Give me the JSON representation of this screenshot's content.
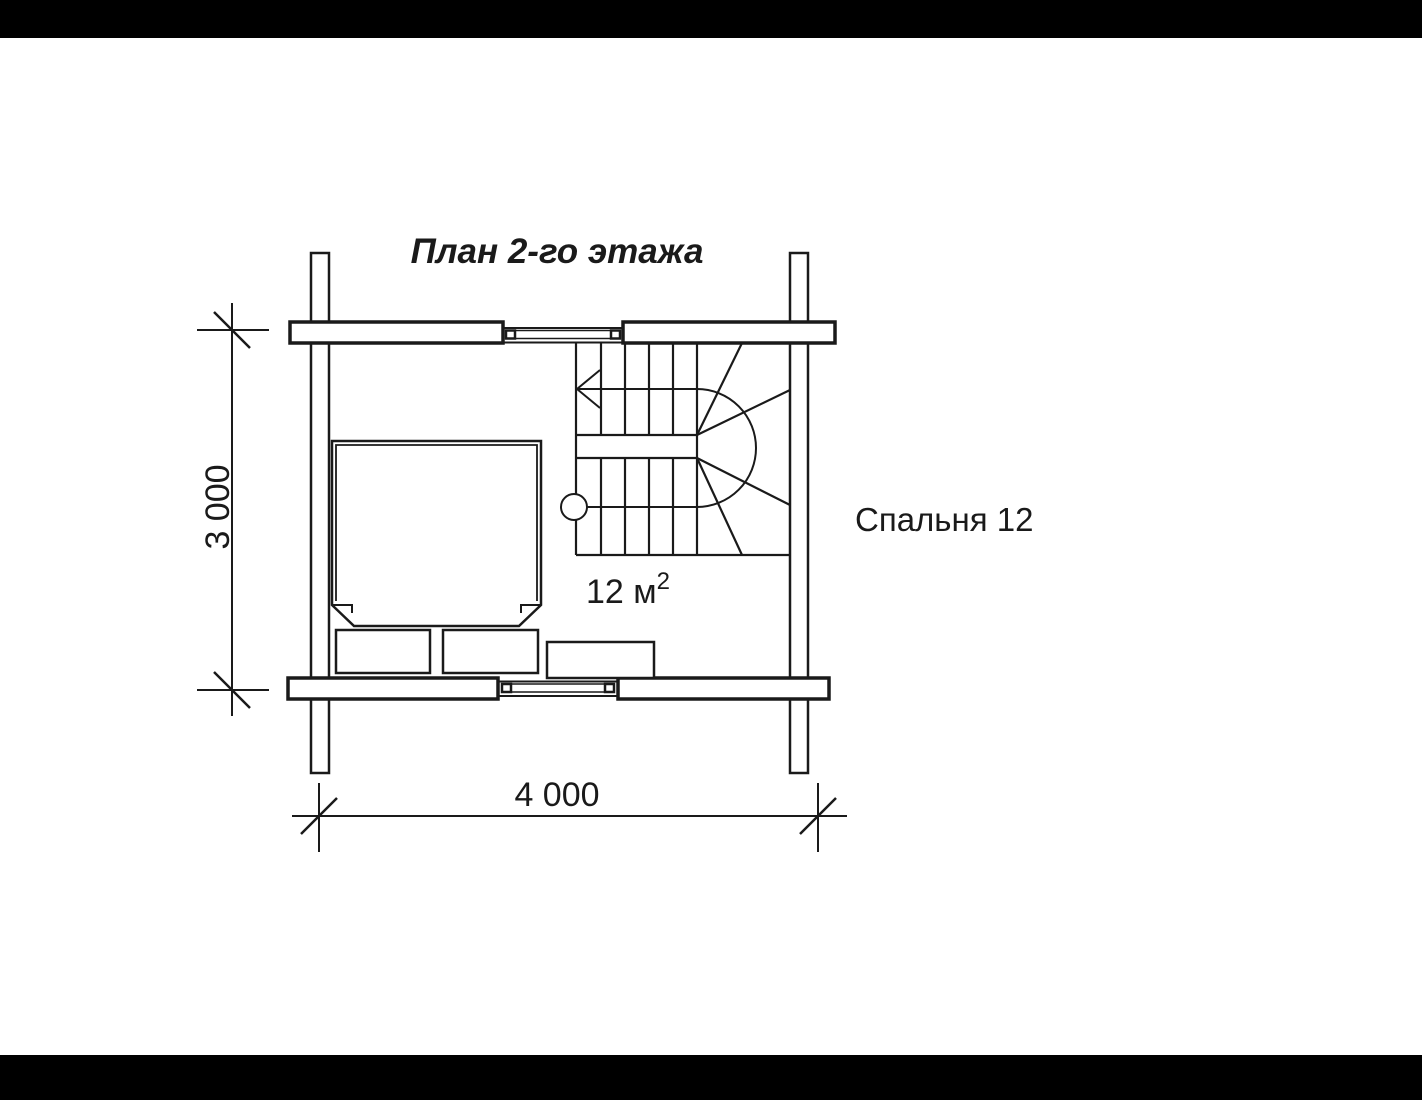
{
  "title": "План 2-го этажа",
  "room": {
    "name": "Спальня 12",
    "area_value": "12 м",
    "area_superscript": "2"
  },
  "dimensions": {
    "width_label": "4 000",
    "height_label": "3 000"
  },
  "colors": {
    "ink": "#1a1a1a",
    "paper": "#ffffff",
    "letterbox": "#000000"
  }
}
